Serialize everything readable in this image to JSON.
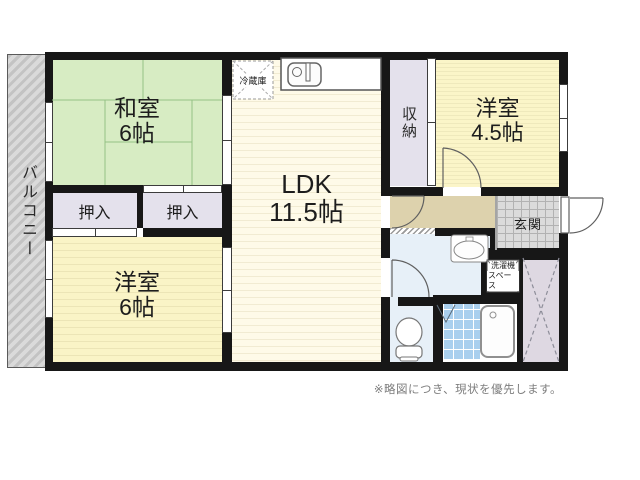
{
  "floorplan": {
    "balcony_label": "バルコニー",
    "washitsu": {
      "name": "和室",
      "size": "6帖"
    },
    "ldk": {
      "name": "LDK",
      "size": "11.5帖"
    },
    "yoshitsu_small": {
      "name": "洋室",
      "size": "4.5帖"
    },
    "yoshitsu_large": {
      "name": "洋室",
      "size": "6帖"
    },
    "oshiire_left": "押入",
    "oshiire_right": "押入",
    "storage_label": "収納",
    "genkan_label": "玄関",
    "refrigerator_label": "冷蔵庫",
    "washer_space": {
      "line1": "洗濯機",
      "line2": "スペース"
    },
    "note": "※略図につき、現状を優先します。",
    "colors": {
      "wall": "#171717",
      "tatami_green": "#d7ecc3",
      "room_yellow": "#faf4c6",
      "ldk_cream": "#fefae8",
      "closet_lavender": "#e4e1ec",
      "hallway_beige": "#ddd2ad",
      "washroom_blue": "#e7f0f8",
      "bath_tile_blue": "#a9cfee",
      "genkan_gray": "#dbdbdb",
      "balcony_gray": "#c9c9c9",
      "storage_x_lavender": "#ded8e2"
    }
  }
}
